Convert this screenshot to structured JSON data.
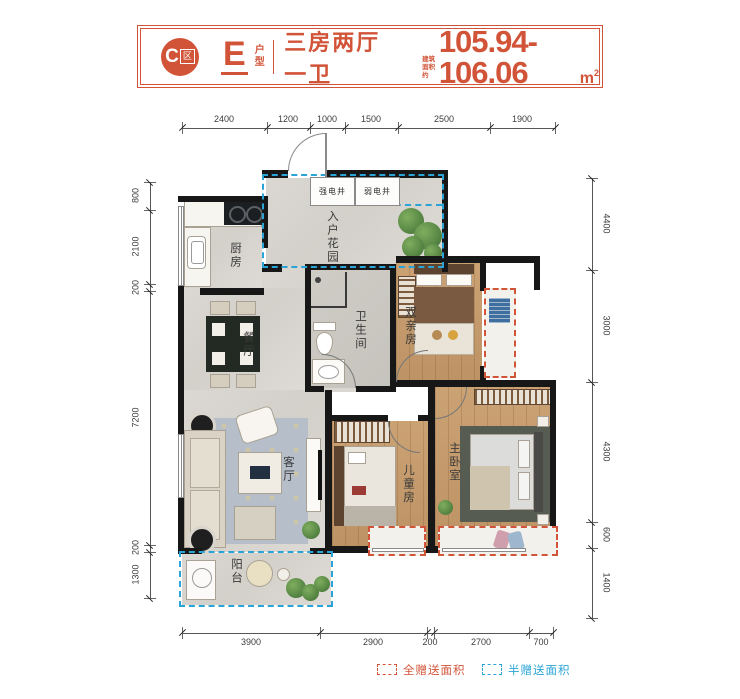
{
  "header": {
    "zone_letter": "C",
    "zone_char": "区",
    "type_letter": "E",
    "type_word_1": "户",
    "type_word_2": "型",
    "layout": "三房两厅一卫",
    "area_note_1": "建筑",
    "area_note_2": "面积约",
    "area_value": "105.94-106.06",
    "area_unit": "m",
    "area_exp": "2"
  },
  "dims": {
    "top": [
      "2400",
      "1200",
      "1000",
      "1500",
      "2500",
      "1900"
    ],
    "bottom": [
      "3900",
      "2900",
      "200",
      "2700",
      "700"
    ],
    "left": [
      "800",
      "2100",
      "200",
      "7200",
      "200",
      "1300"
    ],
    "right": [
      "4400",
      "3000",
      "4300",
      "600",
      "1400"
    ]
  },
  "rooms": {
    "kitchen": "厨房",
    "strong_shaft": "强电井",
    "weak_shaft": "弱电井",
    "entry_garden": "入户花园",
    "dining": "餐厅",
    "bath": "卫生间",
    "parents": "双亲房",
    "living": "客厅",
    "kids": "儿童房",
    "master": "主卧室",
    "balcony": "阳台"
  },
  "legend": {
    "full": "全赠送面积",
    "half": "半赠送面积"
  },
  "colors": {
    "accent": "#d25438",
    "blue": "#2aa4d6"
  }
}
